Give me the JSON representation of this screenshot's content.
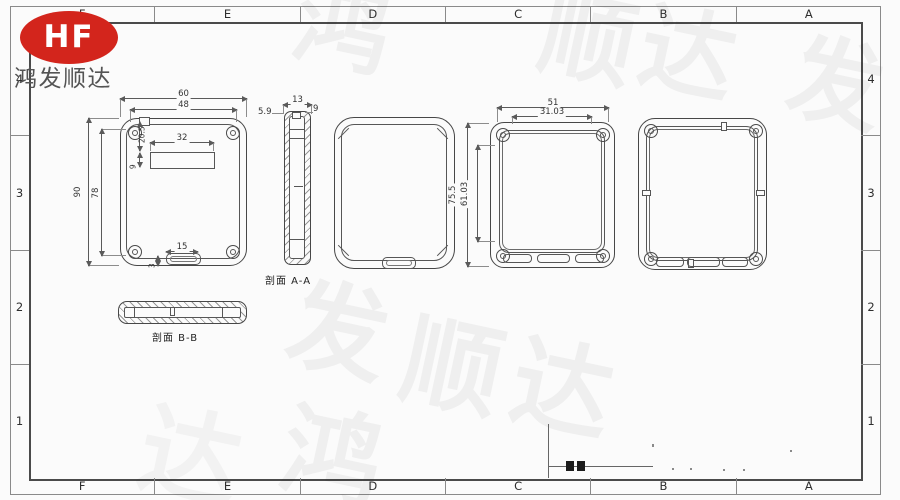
{
  "colors": {
    "logo_red": "#d3251c",
    "line": "#4a4a4a",
    "dim_text": "#333333",
    "sheet_bg": "#fbfbfb"
  },
  "logo": {
    "monogram": "HF",
    "company": "鸿发顺达"
  },
  "grid": {
    "cols": [
      "F",
      "E",
      "D",
      "C",
      "B",
      "A"
    ],
    "rows": [
      "4",
      "3",
      "2",
      "1"
    ]
  },
  "watermark": {
    "chars": [
      "鸿",
      "顺",
      "达",
      "发",
      "发",
      "顺",
      "达",
      "鸿",
      "达"
    ]
  },
  "views": {
    "back_view": {
      "dims": {
        "w_outer": "60",
        "w_inner": "48",
        "slot_w": "32",
        "h_outer": "90",
        "h_inner": "78",
        "slot_offset": "20.5",
        "slot_h": "9",
        "tab_w": "15",
        "tab_h": "3"
      }
    },
    "section_a": {
      "label": "剖面 A-A",
      "dims": {
        "width": "13",
        "lip": "5.9",
        "step": "9"
      }
    },
    "front_view": {
      "dims": {
        "w_outer": "51",
        "w_inner": "31.03",
        "h_outer": "75.5",
        "h_inner": "61.03"
      }
    },
    "section_b": {
      "label": "剖面 B-B"
    }
  }
}
